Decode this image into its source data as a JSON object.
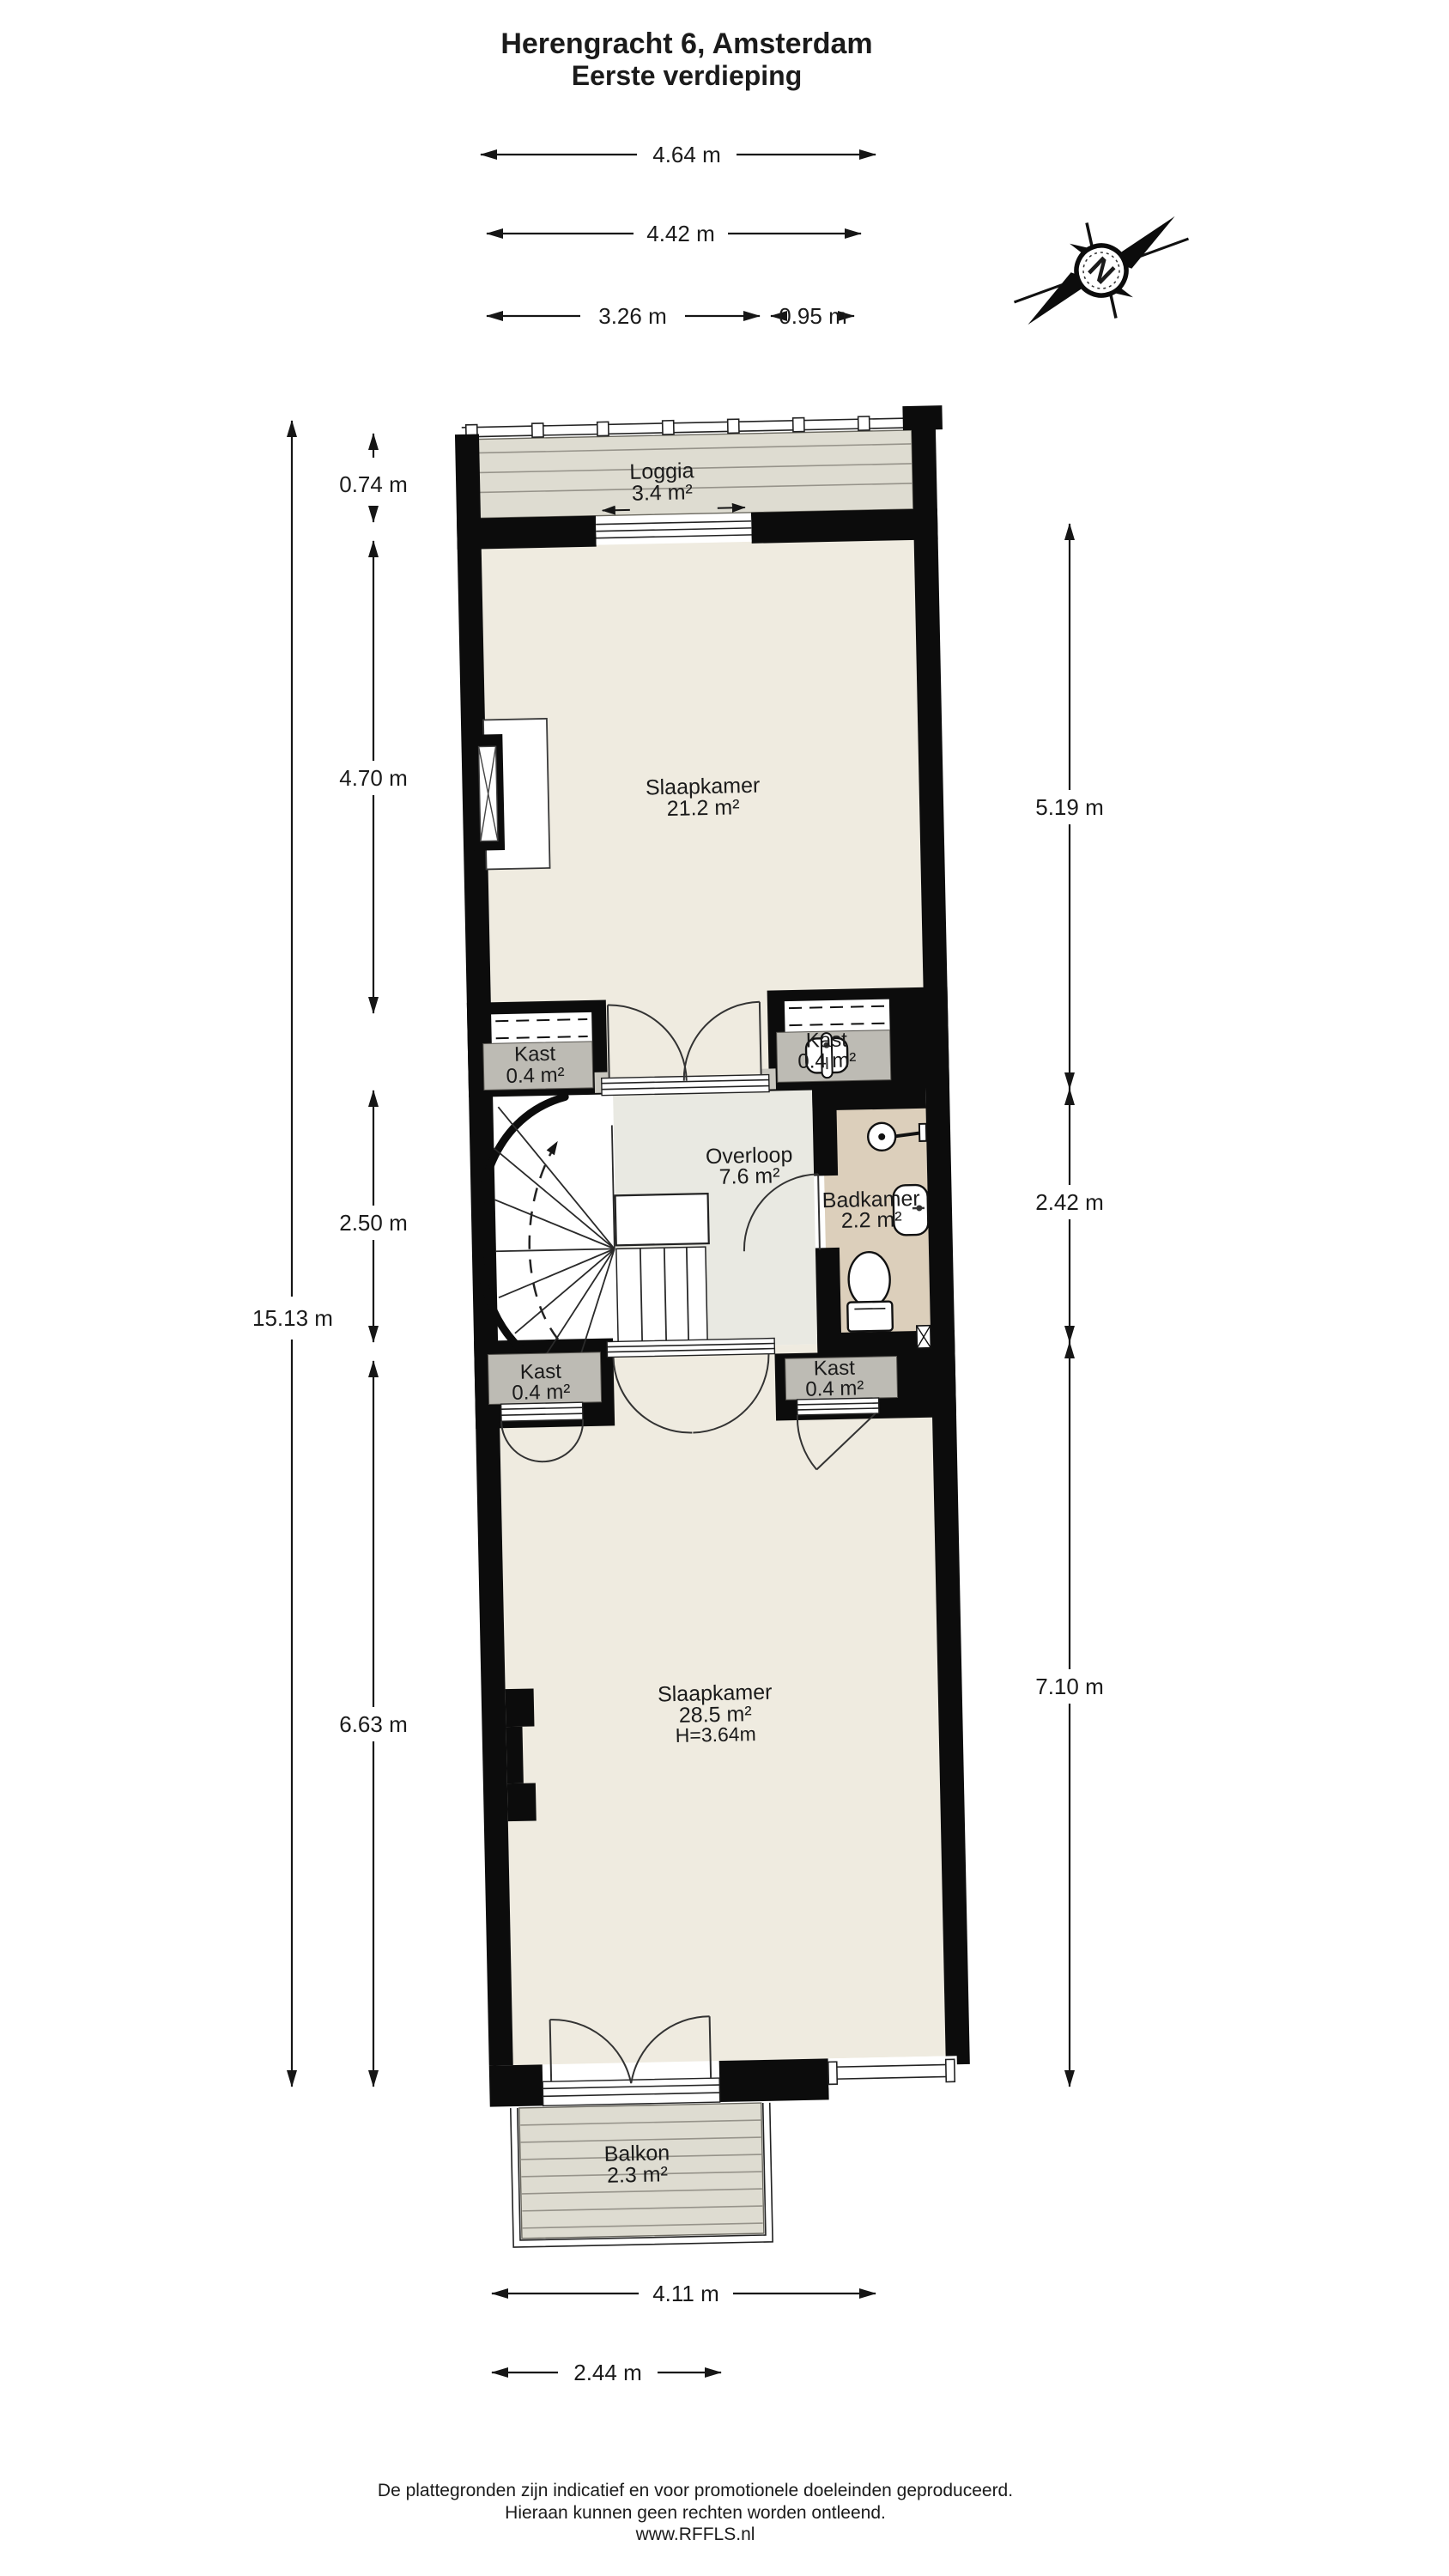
{
  "page_title": "Herengracht 6, Amsterdam",
  "page_subtitle": "Eerste verdieping",
  "compass": {
    "letter": "N"
  },
  "rooms": {
    "loggia": {
      "name": "Loggia",
      "area": "3.4 m²"
    },
    "slaapkamer_boven": {
      "name": "Slaapkamer",
      "area": "21.2 m²"
    },
    "kast_boven_links": {
      "name": "Kast",
      "area": "0.4 m²"
    },
    "kast_boven_rechts": {
      "name": "Kast",
      "area": "0.4 m²"
    },
    "overloop": {
      "name": "Overloop",
      "area": "7.6 m²"
    },
    "badkamer": {
      "name": "Badkamer",
      "area": "2.2 m²"
    },
    "kast_onder_links": {
      "name": "Kast",
      "area": "0.4 m²"
    },
    "kast_onder_rechts": {
      "name": "Kast",
      "area": "0.4 m²"
    },
    "slaapkamer_beneden": {
      "name": "Slaapkamer",
      "area": "28.5 m²",
      "ceiling_height": "H=3.64m"
    },
    "balkon": {
      "name": "Balkon",
      "area": "2.3 m²"
    }
  },
  "dimensions": {
    "top_outer": "4.64 m",
    "top_inner": "4.42 m",
    "top_left_part": "3.26 m",
    "top_right_part": "0.95 m",
    "left_total": "15.13 m",
    "left_loggia": "0.74 m",
    "left_slaapkamer": "4.70 m",
    "left_overloop": "2.50 m",
    "left_slaapkamer2": "6.63 m",
    "right_top": "5.19 m",
    "right_mid": "2.42 m",
    "right_bottom": "7.10 m",
    "bottom_outer": "4.11 m",
    "bottom_balkon": "2.44 m"
  },
  "footer": {
    "line1": "De plattegronden zijn indicatief en voor promotionele doeleinden geproduceerd.",
    "line2": "Hieraan kunnen geen rechten worden ontleend.",
    "line3": "www.RFFLS.nl"
  },
  "colors": {
    "wall": "#0c0c0c",
    "room": "#efebe0",
    "overloop": "#e9e9e2",
    "badkamer": "#dccfbb",
    "kast": "#bdbbb4",
    "deck": "#dedcd1",
    "deck-line": "#96938a",
    "line": "#1b1b1b"
  }
}
